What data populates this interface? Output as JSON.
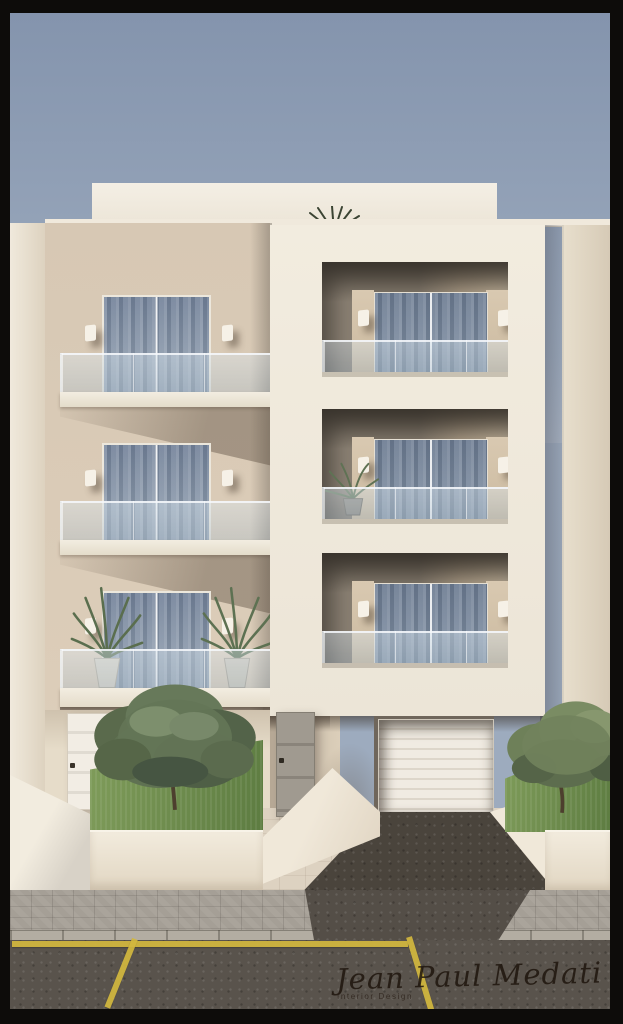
{
  "image": {
    "type": "architectural-3d-render",
    "description": "Front elevation render of a modern three-storey cream apartment building: left wing with cantilevered glass-railed balconies and curtained sliding doors, right wing a white frame volume with three recessed loggias, ground floor with two entrance doors, intercom, basement garage with dark gravel ramp, raised planters with olive trees, potted palms, sidewalk and asphalt road with yellow parking lines under a hazy blue-grey sky.",
    "signature": {
      "name": "Jean Paul Medati",
      "caption": "Interior Design"
    },
    "objects": [
      "sky",
      "roof-parapet",
      "rooftop-agave-plant",
      "left-side-wall",
      "right-side-wall",
      "balcony-top",
      "balcony-middle",
      "balcony-bottom",
      "sliding-glass-doors-with-curtains",
      "wall-sconces",
      "glass-balustrades",
      "white-loggia-block",
      "loggia-top",
      "loggia-middle",
      "loggia-bottom",
      "loggia-potted-plant",
      "balcony-potted-palms",
      "entrance-door-left",
      "entrance-door-center",
      "intercom-box",
      "garage-door",
      "driveway-ramp",
      "planter-left-olive-bush",
      "planter-right-olive-tree",
      "boundary-wall",
      "paved-forecourt",
      "sidewalk",
      "curb",
      "road",
      "yellow-road-lines"
    ],
    "palette": {
      "frame_border": "#0d0c0a",
      "sky_top": "#8494ad",
      "sky_bottom": "#9dabbe",
      "facade_beige": "#d7c8b4",
      "block_white": "#f1ebdf",
      "glass_blue": "#7f8da0",
      "grass_green": "#7f9c5a",
      "olive_green": "#5f7150",
      "asphalt": "#59534c",
      "road_line_yellow": "#d3b83e",
      "paving_cream": "#ddd2c1",
      "sidewalk_grey": "#a59f96"
    }
  }
}
